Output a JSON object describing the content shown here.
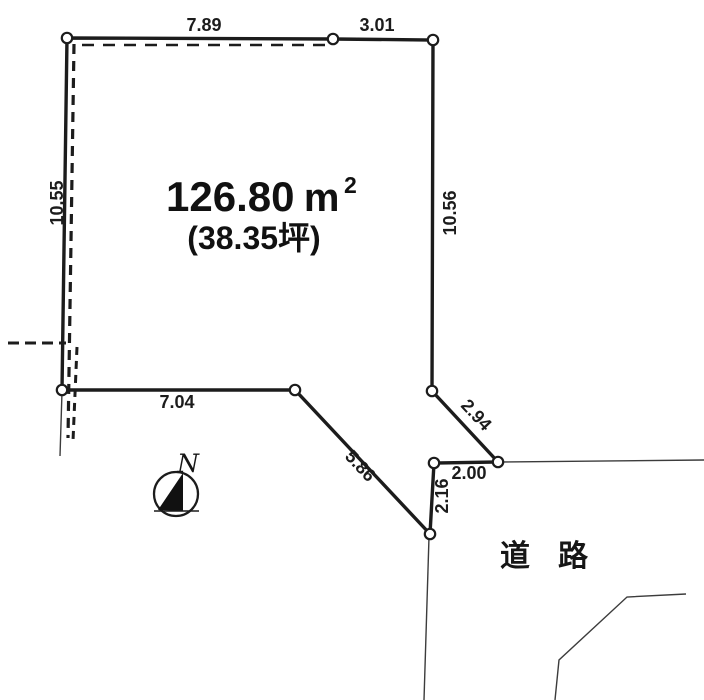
{
  "parcel": {
    "area_sqm": "126.80",
    "area_unit_base": "m",
    "area_unit_exponent": "2",
    "area_tsubo": "(38.35坪)",
    "dimensions": {
      "top_left": "7.89",
      "top_right": "3.01",
      "left_side": "10.55",
      "right_side": "10.56",
      "bottom": "7.04",
      "lower_diagonal": "5.86",
      "upper_diagonal": "2.94",
      "notch_width": "2.00",
      "notch_depth": "2.16"
    }
  },
  "road": {
    "label": "道路"
  },
  "compass": {
    "label": "N"
  },
  "colors": {
    "ink": "#1c1c1c",
    "thin_line": "#3c3c3c",
    "background": "#ffffff"
  }
}
